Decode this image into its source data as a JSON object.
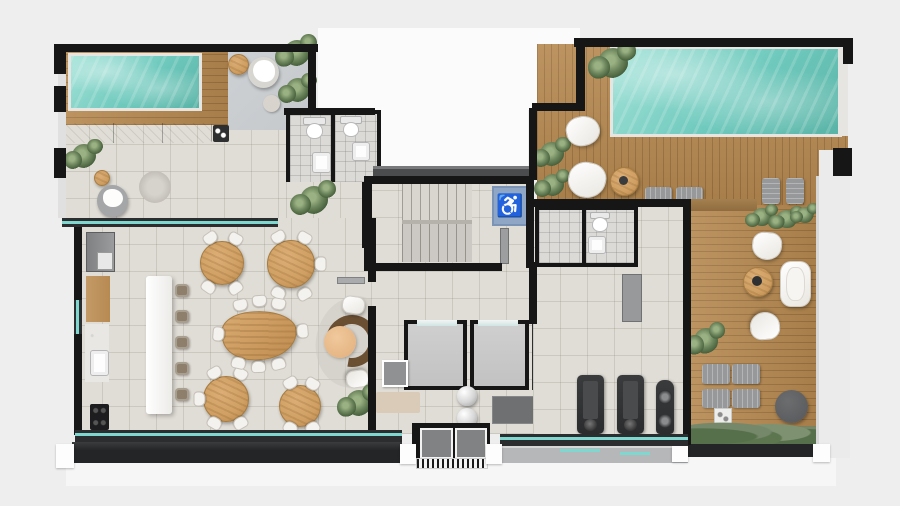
{
  "icons": {
    "accessibility_glyph": "♿"
  },
  "palette": {
    "background": "#eeeeef",
    "void": "#fbfbfc",
    "wall": "#161616",
    "floor": "#e0ddd6",
    "bathroom_floor": "#dbdad7",
    "concrete": "#c5c9cc",
    "pool": "#6fc9bd",
    "pool_light": "#a7e4da",
    "wood": "#b5884f",
    "wood_furn": "#cf9f63",
    "glass": "#7fd8d0",
    "frame": "#2b2d2f",
    "ledge": "#232527",
    "white_furn": "#f4f2ee",
    "gray_furn": "#96989a",
    "dark_gray": "#6e7072",
    "equipment": "#2b2c2e",
    "plant": "#6d855c",
    "plant_dark": "#46603c",
    "sauna_floor": "#c9c9c9",
    "walkway": "#b6b7b9",
    "sign_blue": "#8fa6c4",
    "parapet": "#e6e5e1"
  }
}
